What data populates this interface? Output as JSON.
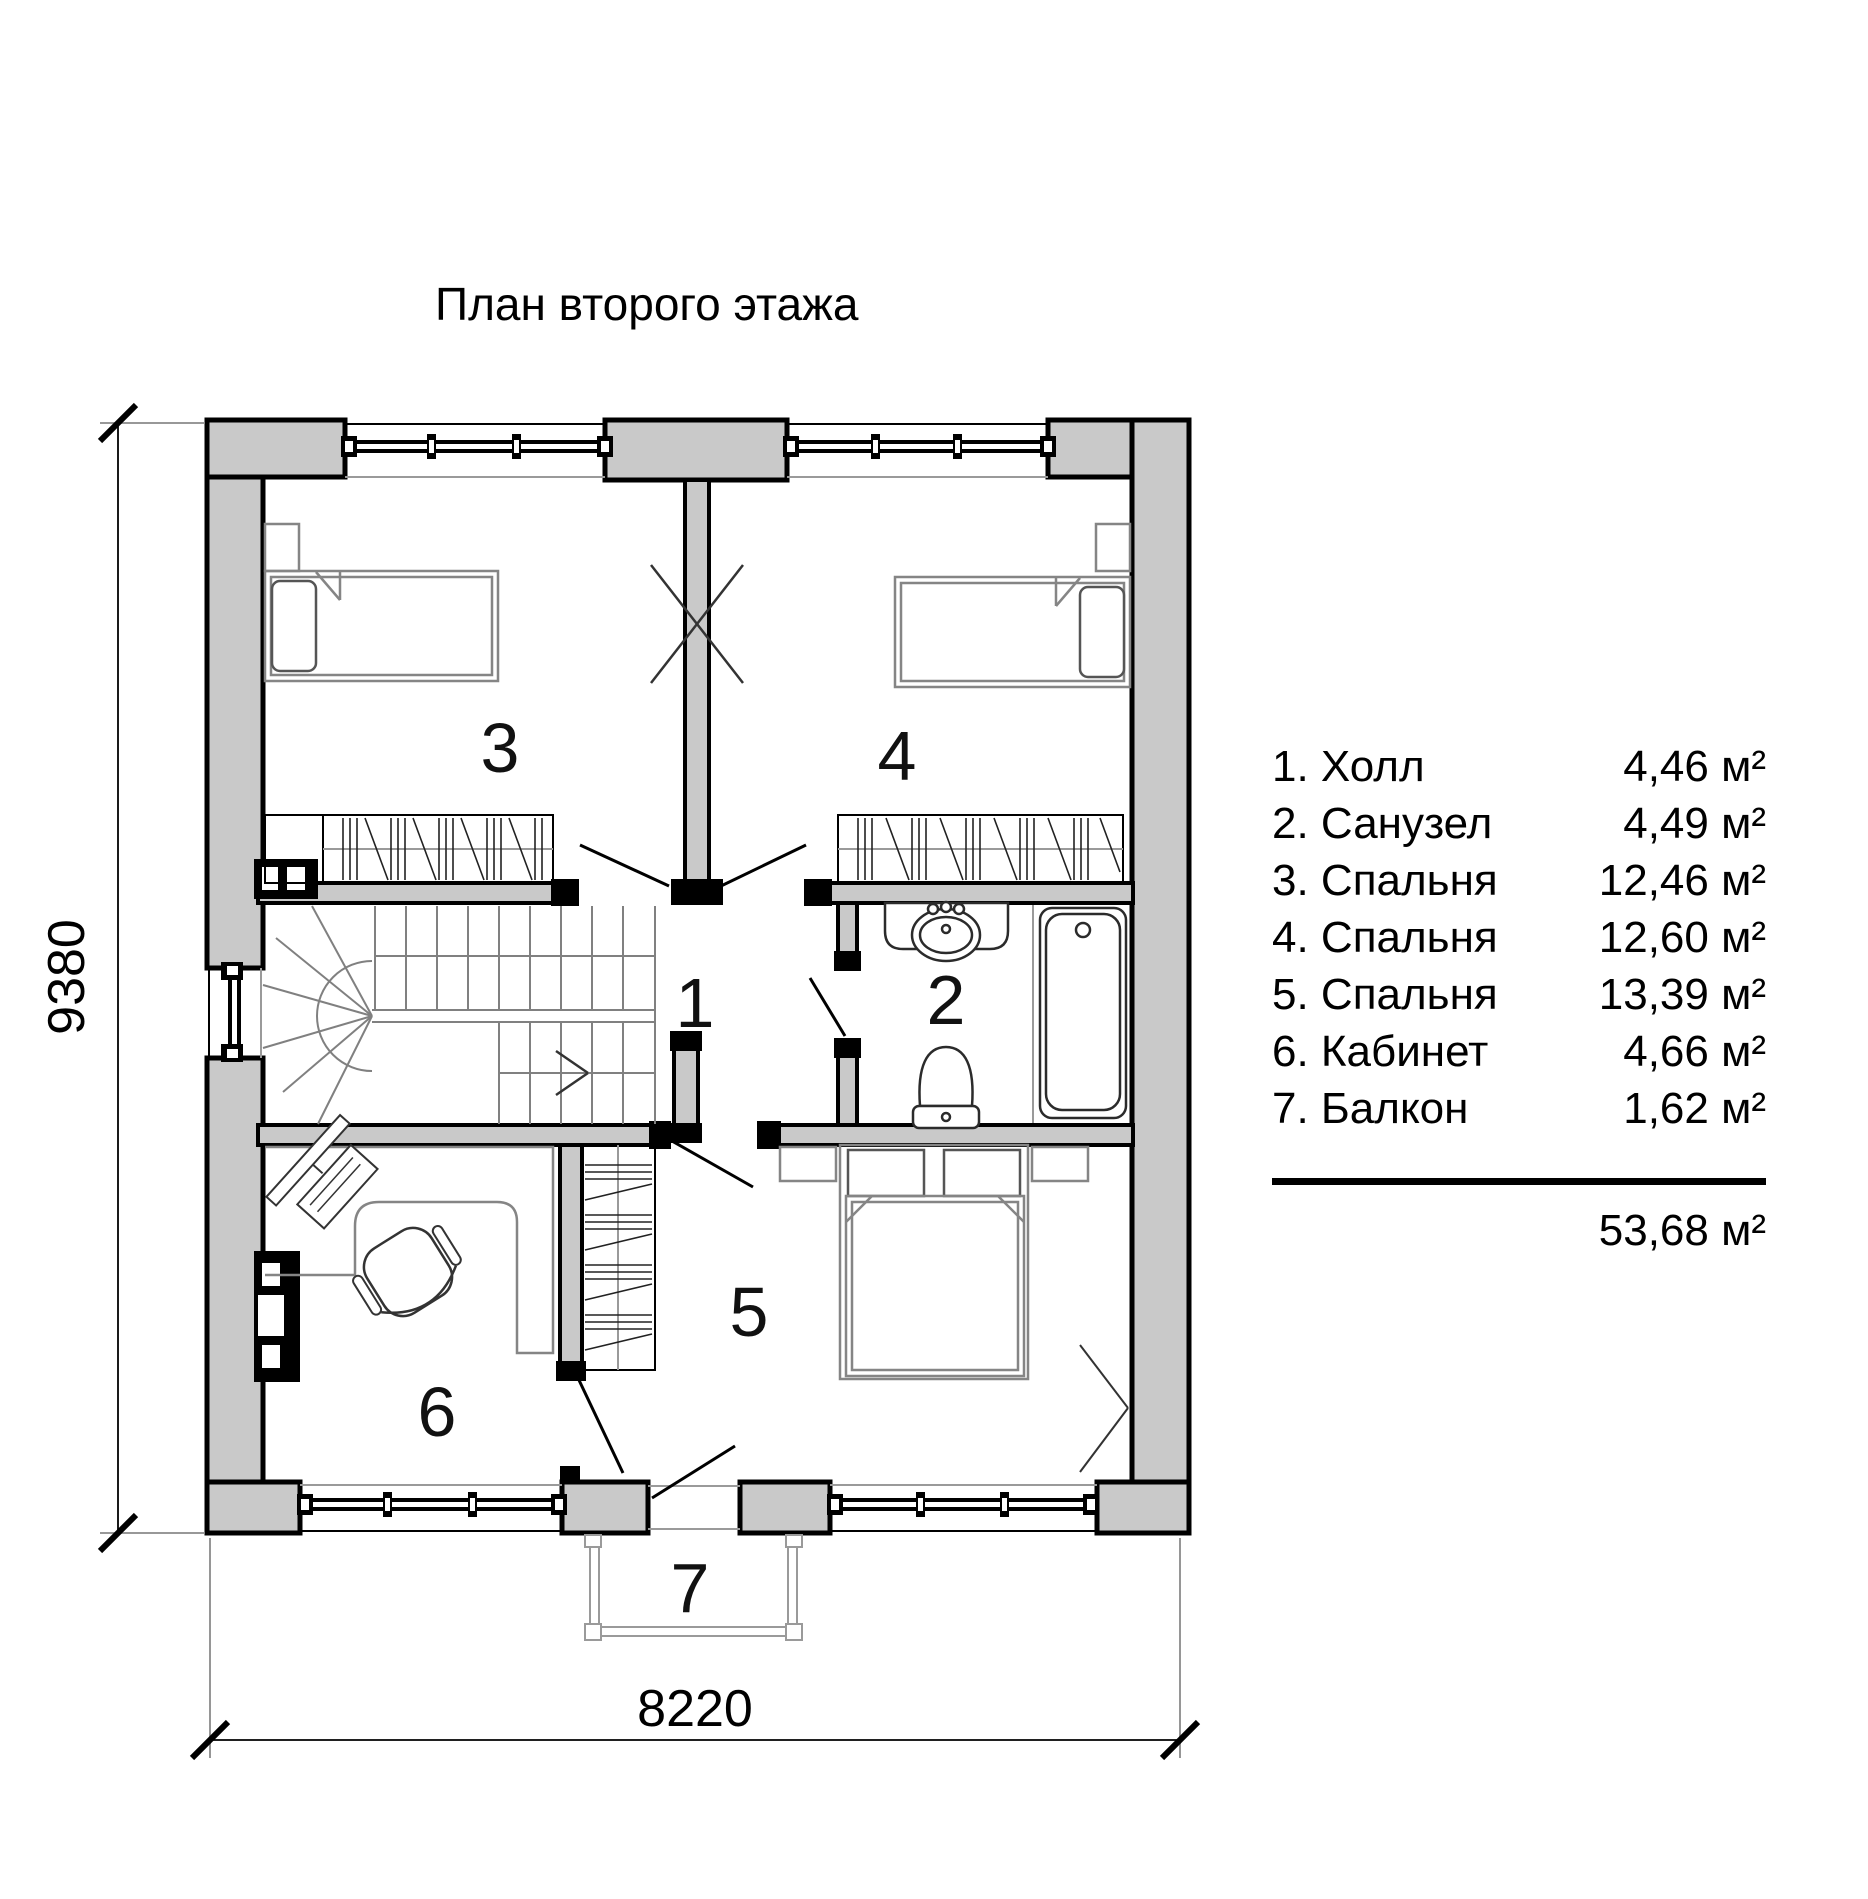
{
  "title": "План второго этажа",
  "dimensions": {
    "height_mm": "9380",
    "width_mm": "8220"
  },
  "rooms": {
    "hall": "1",
    "bathroom": "2",
    "bedroom_a": "3",
    "bedroom_b": "4",
    "bedroom_c": "5",
    "office": "6",
    "balcony": "7"
  },
  "legend": {
    "items": [
      {
        "label": "1. Холл",
        "area": "4,46 м²"
      },
      {
        "label": "2. Санузел",
        "area": "4,49 м²"
      },
      {
        "label": "3. Спальня",
        "area": "12,46 м²"
      },
      {
        "label": "4. Спальня",
        "area": "12,60 м²"
      },
      {
        "label": "5. Спальня",
        "area": "13,39 м²"
      },
      {
        "label": "6. Кабинет",
        "area": "4,66 м²"
      },
      {
        "label": "7. Балкон",
        "area": "1,62 м²"
      }
    ],
    "total": "53,68 м²"
  },
  "colors": {
    "wall_fill": "#c9c9c9",
    "line": "#000000",
    "furniture": "#808080"
  }
}
